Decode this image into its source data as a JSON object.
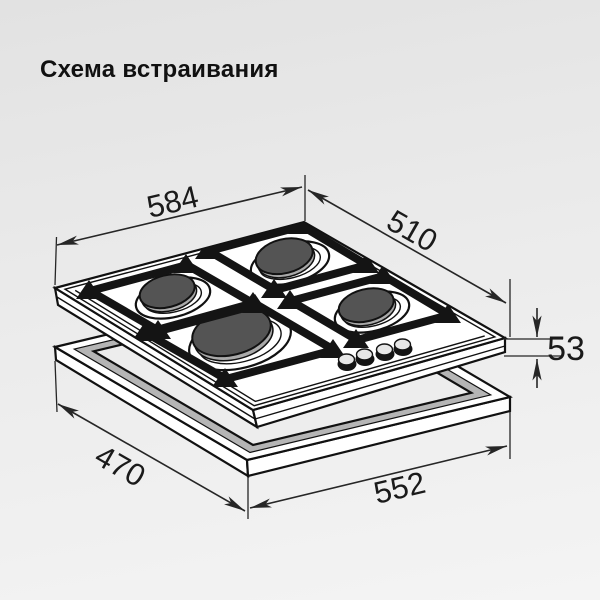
{
  "title": "Схема встраивания",
  "diagram": {
    "dims": {
      "hob_width": "584",
      "hob_depth": "510",
      "hob_height": "53",
      "cutout_depth": "470",
      "cutout_width": "552"
    },
    "colors": {
      "line": "#262626",
      "text": "#1a1a1a",
      "grid_black": "#141414",
      "burner_cap": "#545454",
      "burner_cap_rim": "#a9a9a9",
      "hob_surface": "#ffffff",
      "cutout_inner_wall": "#b5b5b5",
      "background_top": "#e2e2e2",
      "background_bottom": "#f4f4f4"
    }
  }
}
